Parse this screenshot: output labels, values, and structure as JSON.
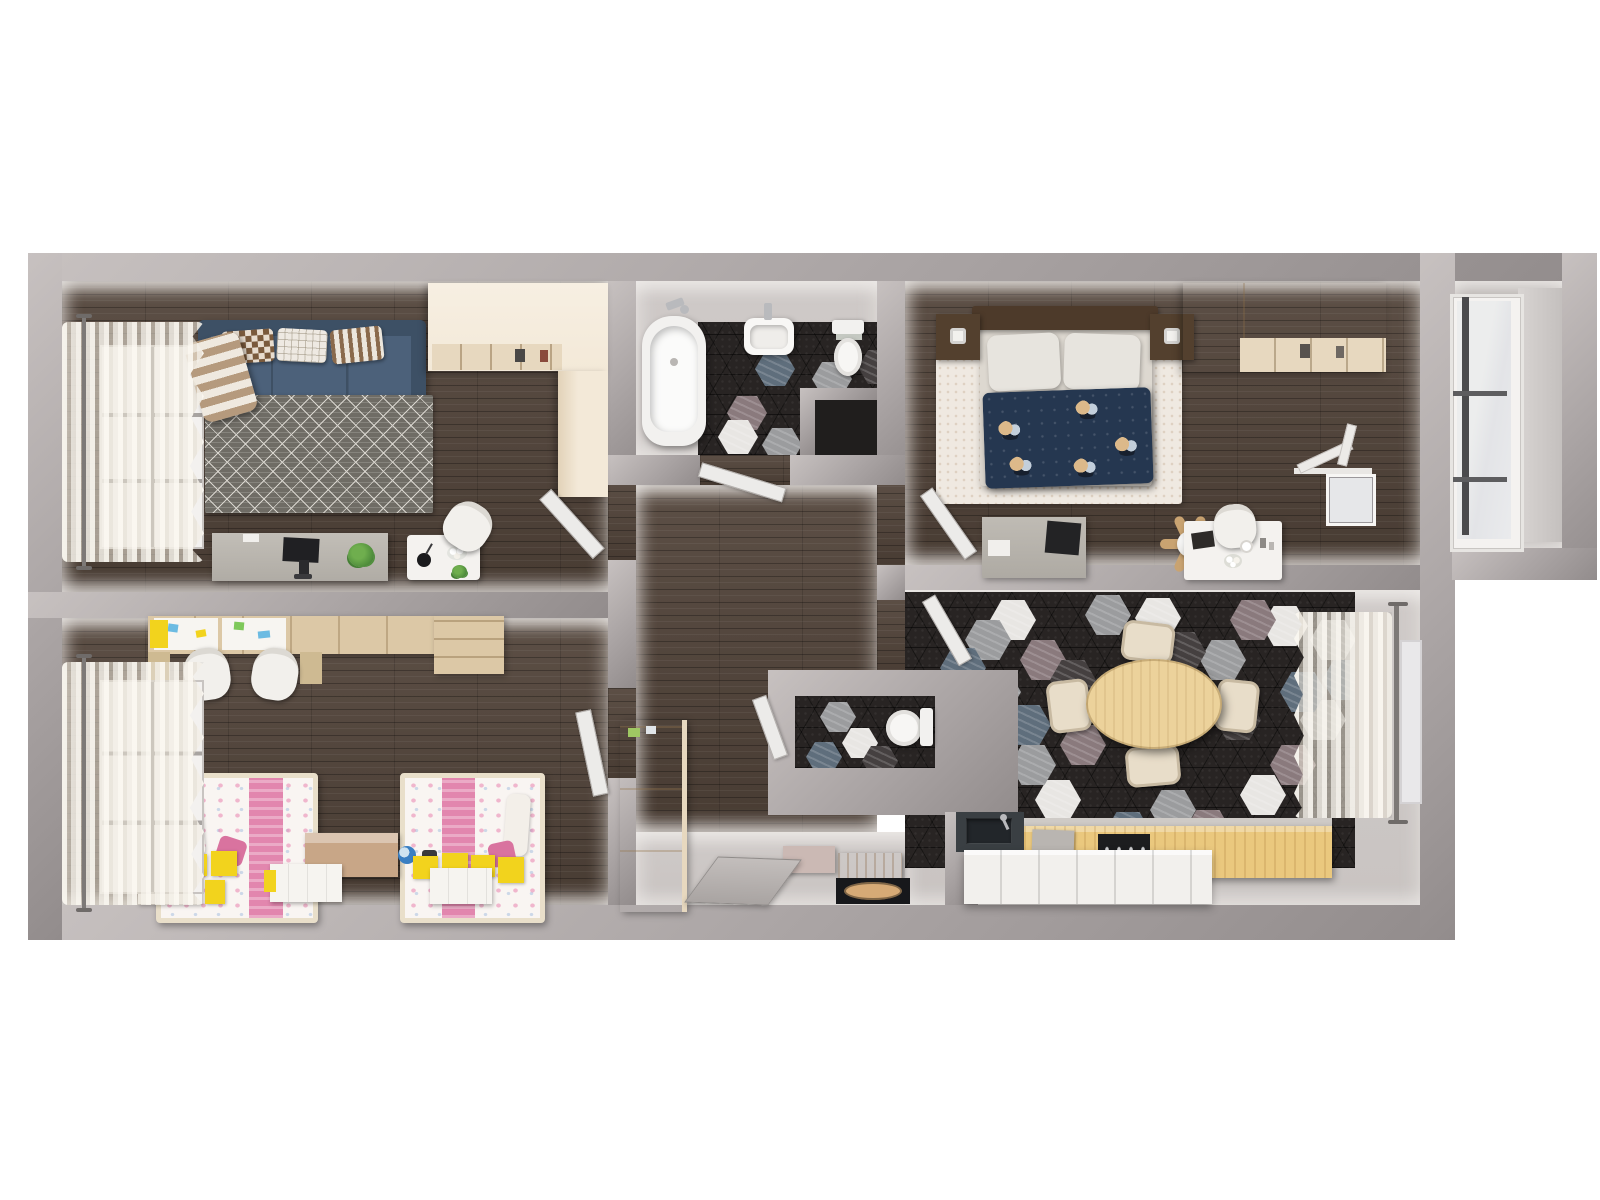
{
  "palette": {
    "background": "#ffffff",
    "wall": "#aaa4a4",
    "wall_light": "#c7c1c0",
    "wall_dark": "#928c8c",
    "wood_floor": "#52443a",
    "gray_floor": "#c9c4c2",
    "balcony_floor": "#b7b2b0",
    "tile_dark": "#282423",
    "hex_white": "#e8e6e3",
    "hex_gray": "#9b9c9e",
    "hex_blue": "#5f6e7c",
    "hex_mauve": "#8a7a7d",
    "hex_mid": "#454040",
    "cream": "#f3e9d8",
    "cream_shade": "#e7d8bf",
    "wood_accent": "#dcc8a6",
    "wood_mid": "#c9a371",
    "wood_chest": "#c8a687",
    "sofa_blue": "#4c617a",
    "sofa_blue_dark": "#3d5065",
    "rug_gray": "#6f6c65",
    "rug_line": "#d8d5ce",
    "bed_navy": "#253750",
    "pink": "#e286ae",
    "floral_white": "#f9f5f2",
    "yellow": "#f2d31d",
    "white_furniture": "#f4f2ef",
    "counter_wood": "#eac87e",
    "table_wood": "#ecd29b",
    "chair_cream": "#e8ddc9",
    "dark_appliance": "#1c1d1f",
    "chrome": "#b9babd",
    "plant_green": "#4e8c3b",
    "curtain": "#efe8da",
    "doormat_dark": "#17181b",
    "doormat_oval": "#d6aa76",
    "door_leaf": "#ecebe9"
  },
  "scene": {
    "type": "3d-floor-plan-top-down-render",
    "rooms": [
      {
        "id": "living-room",
        "floor": "dark-wood",
        "items": [
          "blue-sofa",
          "three-pillows",
          "plaid-blanket",
          "triangle-pattern-rug",
          "computer-desk",
          "monitor",
          "side-table",
          "white-chair",
          "cream-wardrobe",
          "window-with-sheer-curtain"
        ]
      },
      {
        "id": "children-room",
        "floor": "dark-wood",
        "items": [
          "double-study-desk",
          "two-white-chairs",
          "two-kids-beds-pink-floral",
          "toy-chest",
          "globe",
          "yellow-storage-boxes",
          "window-with-sheer-curtain"
        ]
      },
      {
        "id": "bathroom",
        "floor": "dark-hex-tile",
        "items": [
          "bathtub",
          "washbasin",
          "toilet"
        ]
      },
      {
        "id": "hallway",
        "floor": "dark-wood",
        "items": [
          "tall-cream-cabinet",
          "entry-bench",
          "doormat",
          "open-doors"
        ]
      },
      {
        "id": "wc",
        "floor": "dark-hex-tile",
        "items": [
          "toilet"
        ]
      },
      {
        "id": "bedroom",
        "floor": "dark-wood",
        "items": [
          "double-bed-navy-floral-duvet",
          "two-nightstands-with-lamps",
          "cream-wardrobe",
          "desk-with-monitor",
          "vanity-table",
          "ceiling-fan",
          "open-window"
        ]
      },
      {
        "id": "kitchen-dining",
        "floor": "hex-tile-mix",
        "items": [
          "oval-dining-table",
          "four-cream-chairs",
          "kitchen-counter",
          "stove",
          "sink",
          "window-with-sheer-curtain"
        ]
      },
      {
        "id": "balcony",
        "floor": "gray",
        "items": [
          "full-height-glazing"
        ]
      }
    ]
  },
  "hex_tiles": {
    "kitchen": {
      "container": "kitchen-tiles",
      "w": 46,
      "h": 40,
      "tiles": [
        [
          85,
          8,
          "white"
        ],
        [
          357,
          14,
          "white"
        ],
        [
          130,
          188,
          "white"
        ],
        [
          335,
          183,
          "white"
        ],
        [
          50,
          108,
          "white"
        ],
        [
          230,
          6,
          "white"
        ],
        [
          60,
          28,
          "gray"
        ],
        [
          180,
          3,
          "gray"
        ],
        [
          295,
          48,
          "gray"
        ],
        [
          395,
          108,
          "gray"
        ],
        [
          105,
          153,
          "gray"
        ],
        [
          245,
          198,
          "gray"
        ],
        [
          405,
          28,
          "gray"
        ],
        [
          70,
          80,
          "gray"
        ],
        [
          115,
          48,
          "mauve"
        ],
        [
          325,
          8,
          "mauve"
        ],
        [
          365,
          153,
          "mauve"
        ],
        [
          155,
          133,
          "mauve"
        ],
        [
          280,
          218,
          "mauve"
        ],
        [
          35,
          56,
          "blue"
        ],
        [
          200,
          220,
          "blue"
        ],
        [
          417,
          68,
          "blue"
        ],
        [
          100,
          113,
          "blue"
        ],
        [
          375,
          80,
          "blue"
        ],
        [
          255,
          40,
          "mid"
        ],
        [
          185,
          98,
          "mid"
        ],
        [
          310,
          108,
          "mid"
        ],
        [
          145,
          68,
          "mid"
        ]
      ]
    },
    "bathroom": {
      "container": "bath-tiles",
      "w": 40,
      "h": 34,
      "tiles": [
        [
          57,
          30,
          "blue"
        ],
        [
          114,
          40,
          "gray"
        ],
        [
          29,
          74,
          "mauve"
        ],
        [
          20,
          98,
          "white"
        ],
        [
          64,
          106,
          "gray"
        ],
        [
          140,
          76,
          "blue"
        ],
        [
          160,
          28,
          "mid"
        ]
      ]
    },
    "wc": {
      "container": "wc-tiles",
      "w": 36,
      "h": 30,
      "tiles": [
        [
          25,
          6,
          "gray"
        ],
        [
          47,
          32,
          "white"
        ],
        [
          11,
          46,
          "blue"
        ],
        [
          67,
          50,
          "mid"
        ]
      ]
    }
  }
}
